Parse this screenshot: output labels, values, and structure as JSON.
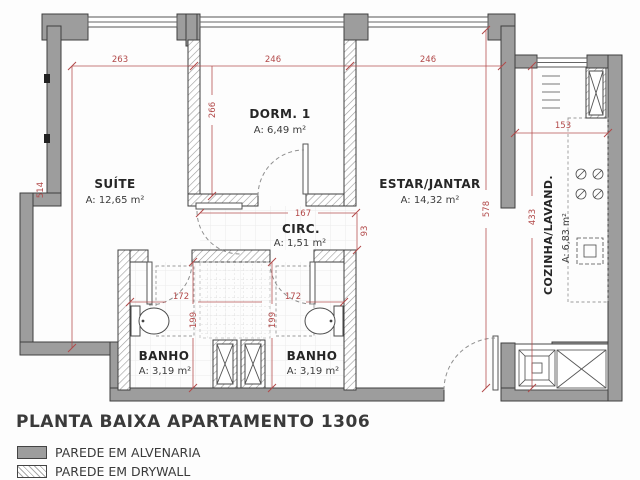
{
  "title": "PLANTA BAIXA APARTAMENTO 1306",
  "legend": {
    "alvenaria_label": "PAREDE EM ALVENARIA",
    "drywall_label": "PAREDE EM DRYWALL"
  },
  "rooms": {
    "suite": {
      "name": "SUÍTE",
      "area": "A: 12,65 m²"
    },
    "dorm1": {
      "name": "DORM. 1",
      "area": "A: 6,49 m²"
    },
    "estar": {
      "name": "ESTAR/JANTAR",
      "area": "A: 14,32 m²"
    },
    "circ": {
      "name": "CIRC.",
      "area": "A: 1,51 m²"
    },
    "cozinha": {
      "name": "COZINHA/LAVAND.",
      "area": "A: 6,83 m²"
    },
    "banho_esq": {
      "name": "BANHO",
      "area": "A: 3,19 m²"
    },
    "banho_dir": {
      "name": "BANHO",
      "area": "A: 3,19 m²"
    }
  },
  "dimensions_cm": {
    "suite_width": "263",
    "dorm1_width": "246",
    "estar_width": "246",
    "left_total_height": "514",
    "dorm1_depth": "266",
    "circ_width": "167",
    "circ_depth": "93",
    "estar_depth": "578",
    "cozinha_width": "153",
    "cozinha_depth": "433",
    "banho_esq_width": "172",
    "banho_esq_depth": "199",
    "banho_dir_width": "172",
    "banho_dir_depth": "199"
  },
  "colors": {
    "wall-fill": "#9d9d9d",
    "wall-stroke": "#3f3f3f",
    "dim-color": "#b24949",
    "label-color": "#262626",
    "fixture-stroke": "#4a4a4a",
    "arc-color": "#8f8f8f"
  }
}
